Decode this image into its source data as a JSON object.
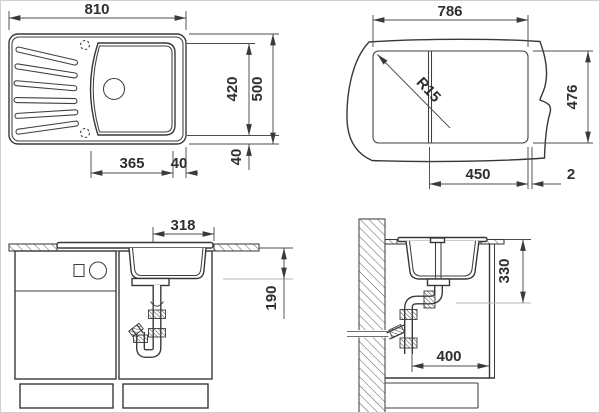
{
  "dims": {
    "top": {
      "width": "810",
      "depth": "500",
      "bowl_depth": "420",
      "bowl_width": "365",
      "side_gap": "40",
      "edge_gap": "40"
    },
    "cutout": {
      "width": "786",
      "depth": "476",
      "bowl_width": "450",
      "corner_radius": "R15",
      "divider": "2"
    },
    "front": {
      "bowl_width": "318",
      "bowl_depth": "190"
    },
    "side": {
      "outlet_depth": "330",
      "outlet_distance": "400"
    }
  },
  "colors": {
    "line": "#383838",
    "dim_line": "#4d4d4d",
    "dim_text": "#2f2f2f",
    "light_line": "#b5b5b5",
    "background": "#ffffff",
    "border": "#cfcfcf"
  }
}
